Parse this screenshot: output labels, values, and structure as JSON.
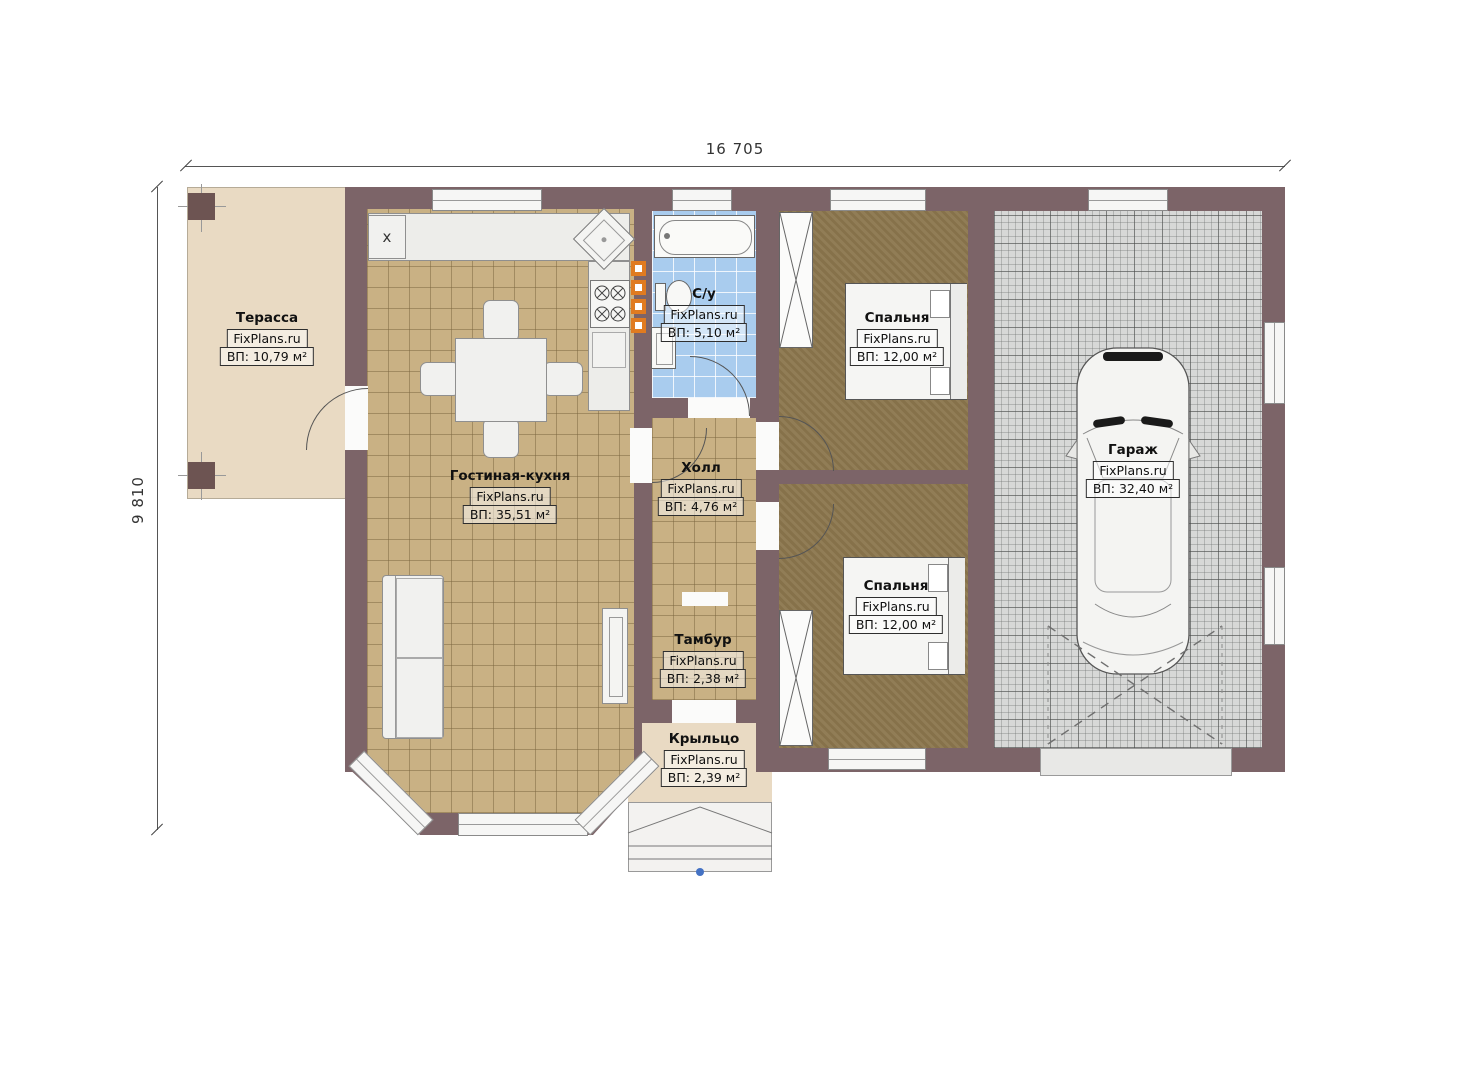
{
  "plan": {
    "dimensions": {
      "width_label": "16 705",
      "height_label": "9 810"
    },
    "kitchen": {
      "appliance_label": "x"
    },
    "rooms": [
      {
        "name": "Терасса",
        "brand": "FixPlans.ru",
        "area": "ВП: 10,79 м²"
      },
      {
        "name": "Гостиная-кухня",
        "brand": "FixPlans.ru",
        "area": "ВП: 35,51 м²"
      },
      {
        "name": "С/у",
        "brand": "FixPlans.ru",
        "area": "ВП: 5,10 м²"
      },
      {
        "name": "Холл",
        "brand": "FixPlans.ru",
        "area": "ВП: 4,76 м²"
      },
      {
        "name": "Спальня",
        "brand": "FixPlans.ru",
        "area": "ВП: 12,00 м²"
      },
      {
        "name": "Спальня",
        "brand": "FixPlans.ru",
        "area": "ВП: 12,00 м²"
      },
      {
        "name": "Гараж",
        "brand": "FixPlans.ru",
        "area": "ВП: 32,40 м²"
      },
      {
        "name": "Тамбур",
        "brand": "FixPlans.ru",
        "area": "ВП: 2,38 м²"
      },
      {
        "name": "Крыльцо",
        "brand": "FixPlans.ru",
        "area": "ВП: 2,39 м²"
      }
    ],
    "colors": {
      "wall": "#7c6468",
      "terrace_floor": "#e9dac3",
      "living_tile": "#c9b184",
      "bedroom_floor": "#8b764d",
      "bathroom_tile": "#a9ccee",
      "garage_tile": "#d7d8d7",
      "heater_accent": "#e07b20",
      "marker_blue": "#4472c4"
    }
  }
}
